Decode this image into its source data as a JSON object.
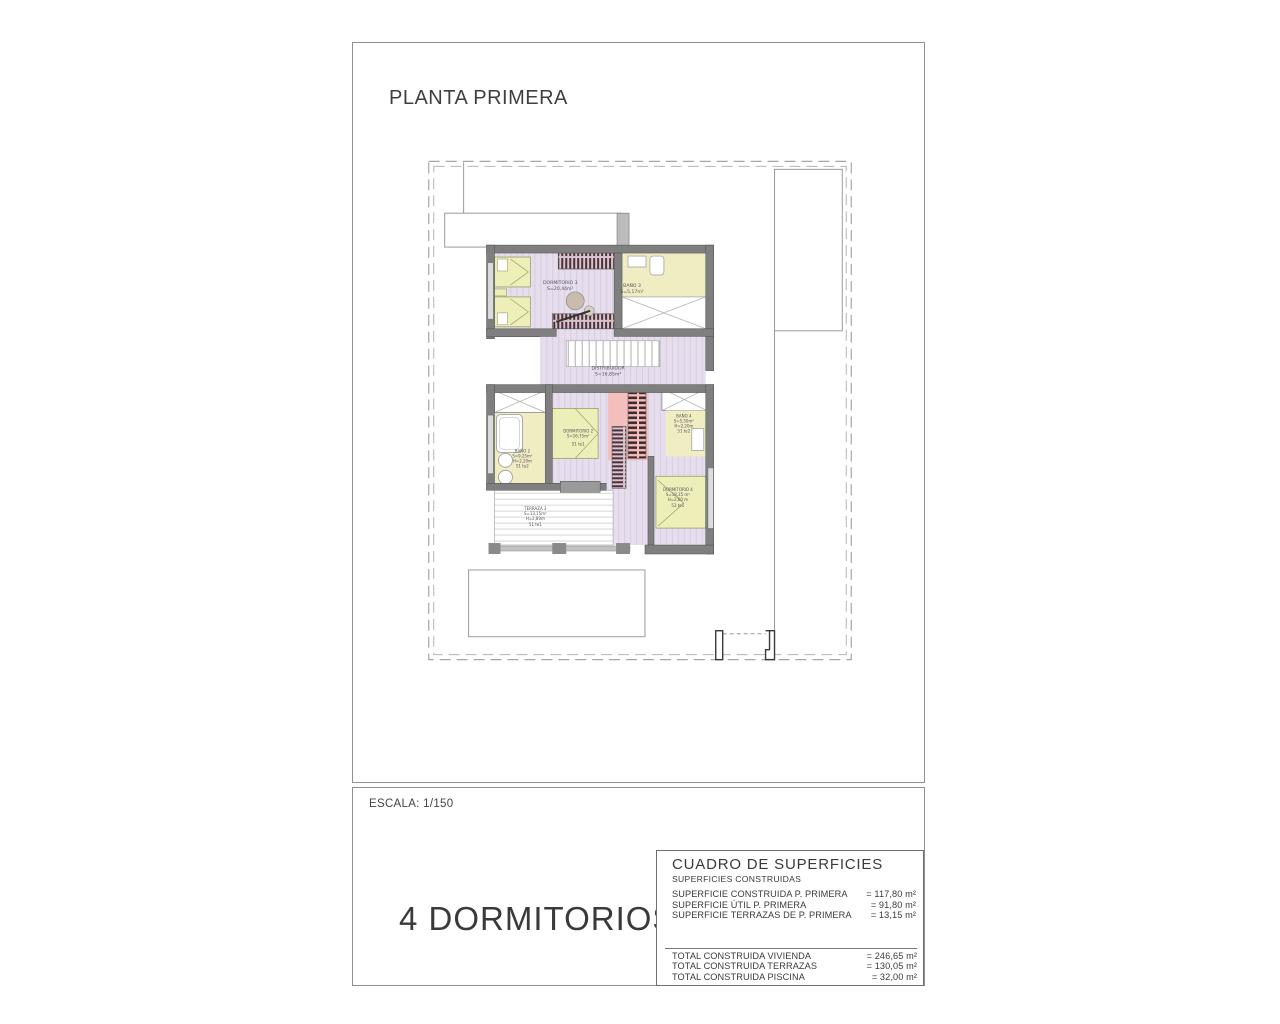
{
  "page": {
    "title": "PLANTA PRIMERA",
    "scale_label": "ESCALA: 1/150",
    "bedrooms_label": "4 DORMITORIOS"
  },
  "plan": {
    "rooms": [
      {
        "name": "DORMITORIO 3",
        "area": "S=20,44m²"
      },
      {
        "name": "BAÑO 3",
        "area": "S=5,17m²"
      },
      {
        "name": "DISTRIBUIDOR",
        "area": "S=16,85m²"
      },
      {
        "name": "DORMITORIO 2",
        "area": "S=16,75m²",
        "code": "51 te1"
      },
      {
        "name": "BAÑO 2",
        "area": "S=9,25m²",
        "height": "H=2,20m",
        "code": "51 te2"
      },
      {
        "name": "BAÑO 4",
        "area": "S=5,50m²",
        "height": "H=2,20m",
        "code": "51 te2"
      },
      {
        "name": "DORMITORIO 4",
        "area": "S=18,35 m²",
        "height": "H=2,60 m",
        "code": "52 te1"
      },
      {
        "name": "TERRAZA 3",
        "area": "S=13,15m²",
        "height": "H=2,80m",
        "code": "51 te1"
      }
    ]
  },
  "surfaces_table": {
    "title": "CUADRO DE SUPERFICIES",
    "subtitle": "SUPERFICIES CONSTRUIDAS",
    "rows": [
      {
        "label": "SUPERFICIE CONSTRUIDA P. PRIMERA",
        "value": "= 117,80 m²"
      },
      {
        "label": "SUPERFICIE ÚTIL P. PRIMERA",
        "value": "= 91,80 m²"
      },
      {
        "label": "SUPERFICIE TERRAZAS DE P. PRIMERA",
        "value": "= 13,15 m²"
      }
    ],
    "totals": [
      {
        "label": "TOTAL CONSTRUIDA VIVIENDA",
        "value": "= 246,65 m²"
      },
      {
        "label": "TOTAL CONSTRUIDA TERRAZAS",
        "value": "= 130,05 m²"
      },
      {
        "label": "TOTAL CONSTRUIDA PISCINA",
        "value": "= 32,00 m²"
      }
    ]
  },
  "colors": {
    "wall": "#7f7f7f",
    "floor_lavender": "#e6dded",
    "floor_yellow": "#f0edc2",
    "bed": "#edeeb8",
    "stairs_pink": "#f4bebc",
    "wardrobe_dark": "#4a3038",
    "boundary_dash": "#a6a6a6"
  }
}
